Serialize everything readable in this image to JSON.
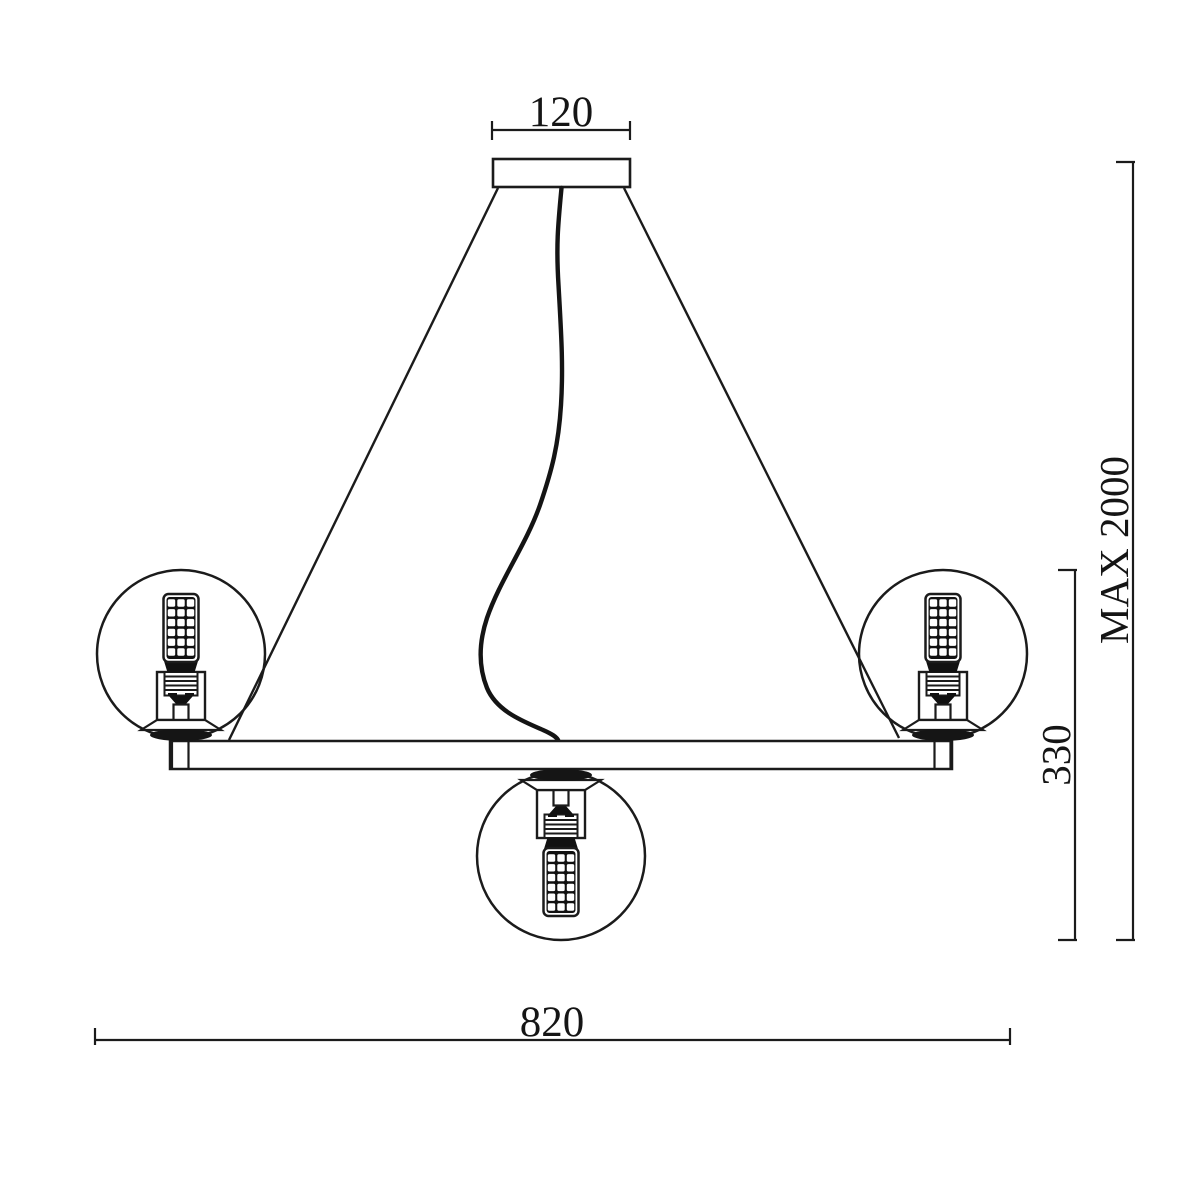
{
  "page": {
    "background_color": "#ffffff",
    "stroke_color": "#1b1b1b"
  },
  "drawing": {
    "kind": "chandelier dimension drawing",
    "dim_canopy": {
      "value": "120",
      "orientation": "horizontal",
      "position": "top"
    },
    "dim_drop": {
      "value": "MAX 2000",
      "orientation": "vertical",
      "position": "right-outer"
    },
    "dim_body": {
      "value": "330",
      "orientation": "vertical",
      "position": "right-inner"
    },
    "dim_width": {
      "value": "820",
      "orientation": "horizontal",
      "position": "bottom"
    }
  }
}
